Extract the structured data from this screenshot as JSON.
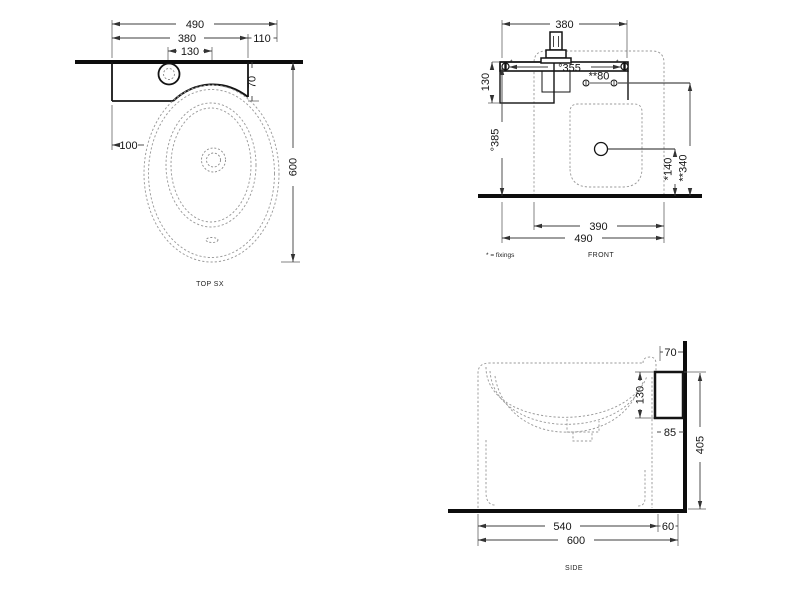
{
  "top": {
    "label": "TOP SX",
    "d490": "490",
    "d380": "380",
    "d130": "130",
    "d110": "110",
    "d70": "70",
    "d100": "100",
    "d600": "600"
  },
  "front": {
    "label": "FRONT",
    "note": "* = fixings",
    "mark": "*",
    "d380": "380",
    "d355": "°355",
    "d80": "**80",
    "d130": "130",
    "d385": "°385",
    "d140": "*140",
    "d340": "**340",
    "d390": "390",
    "d490": "490"
  },
  "side": {
    "label": "SIDE",
    "d70": "70",
    "d130": "130",
    "d85": "85",
    "d405": "405",
    "d540": "540",
    "d60": "60",
    "d600": "600"
  },
  "colors": {
    "line": "#141414",
    "dashed": "#9b9b9b",
    "dimension": "#3c3c3c",
    "background": "#ffffff"
  }
}
